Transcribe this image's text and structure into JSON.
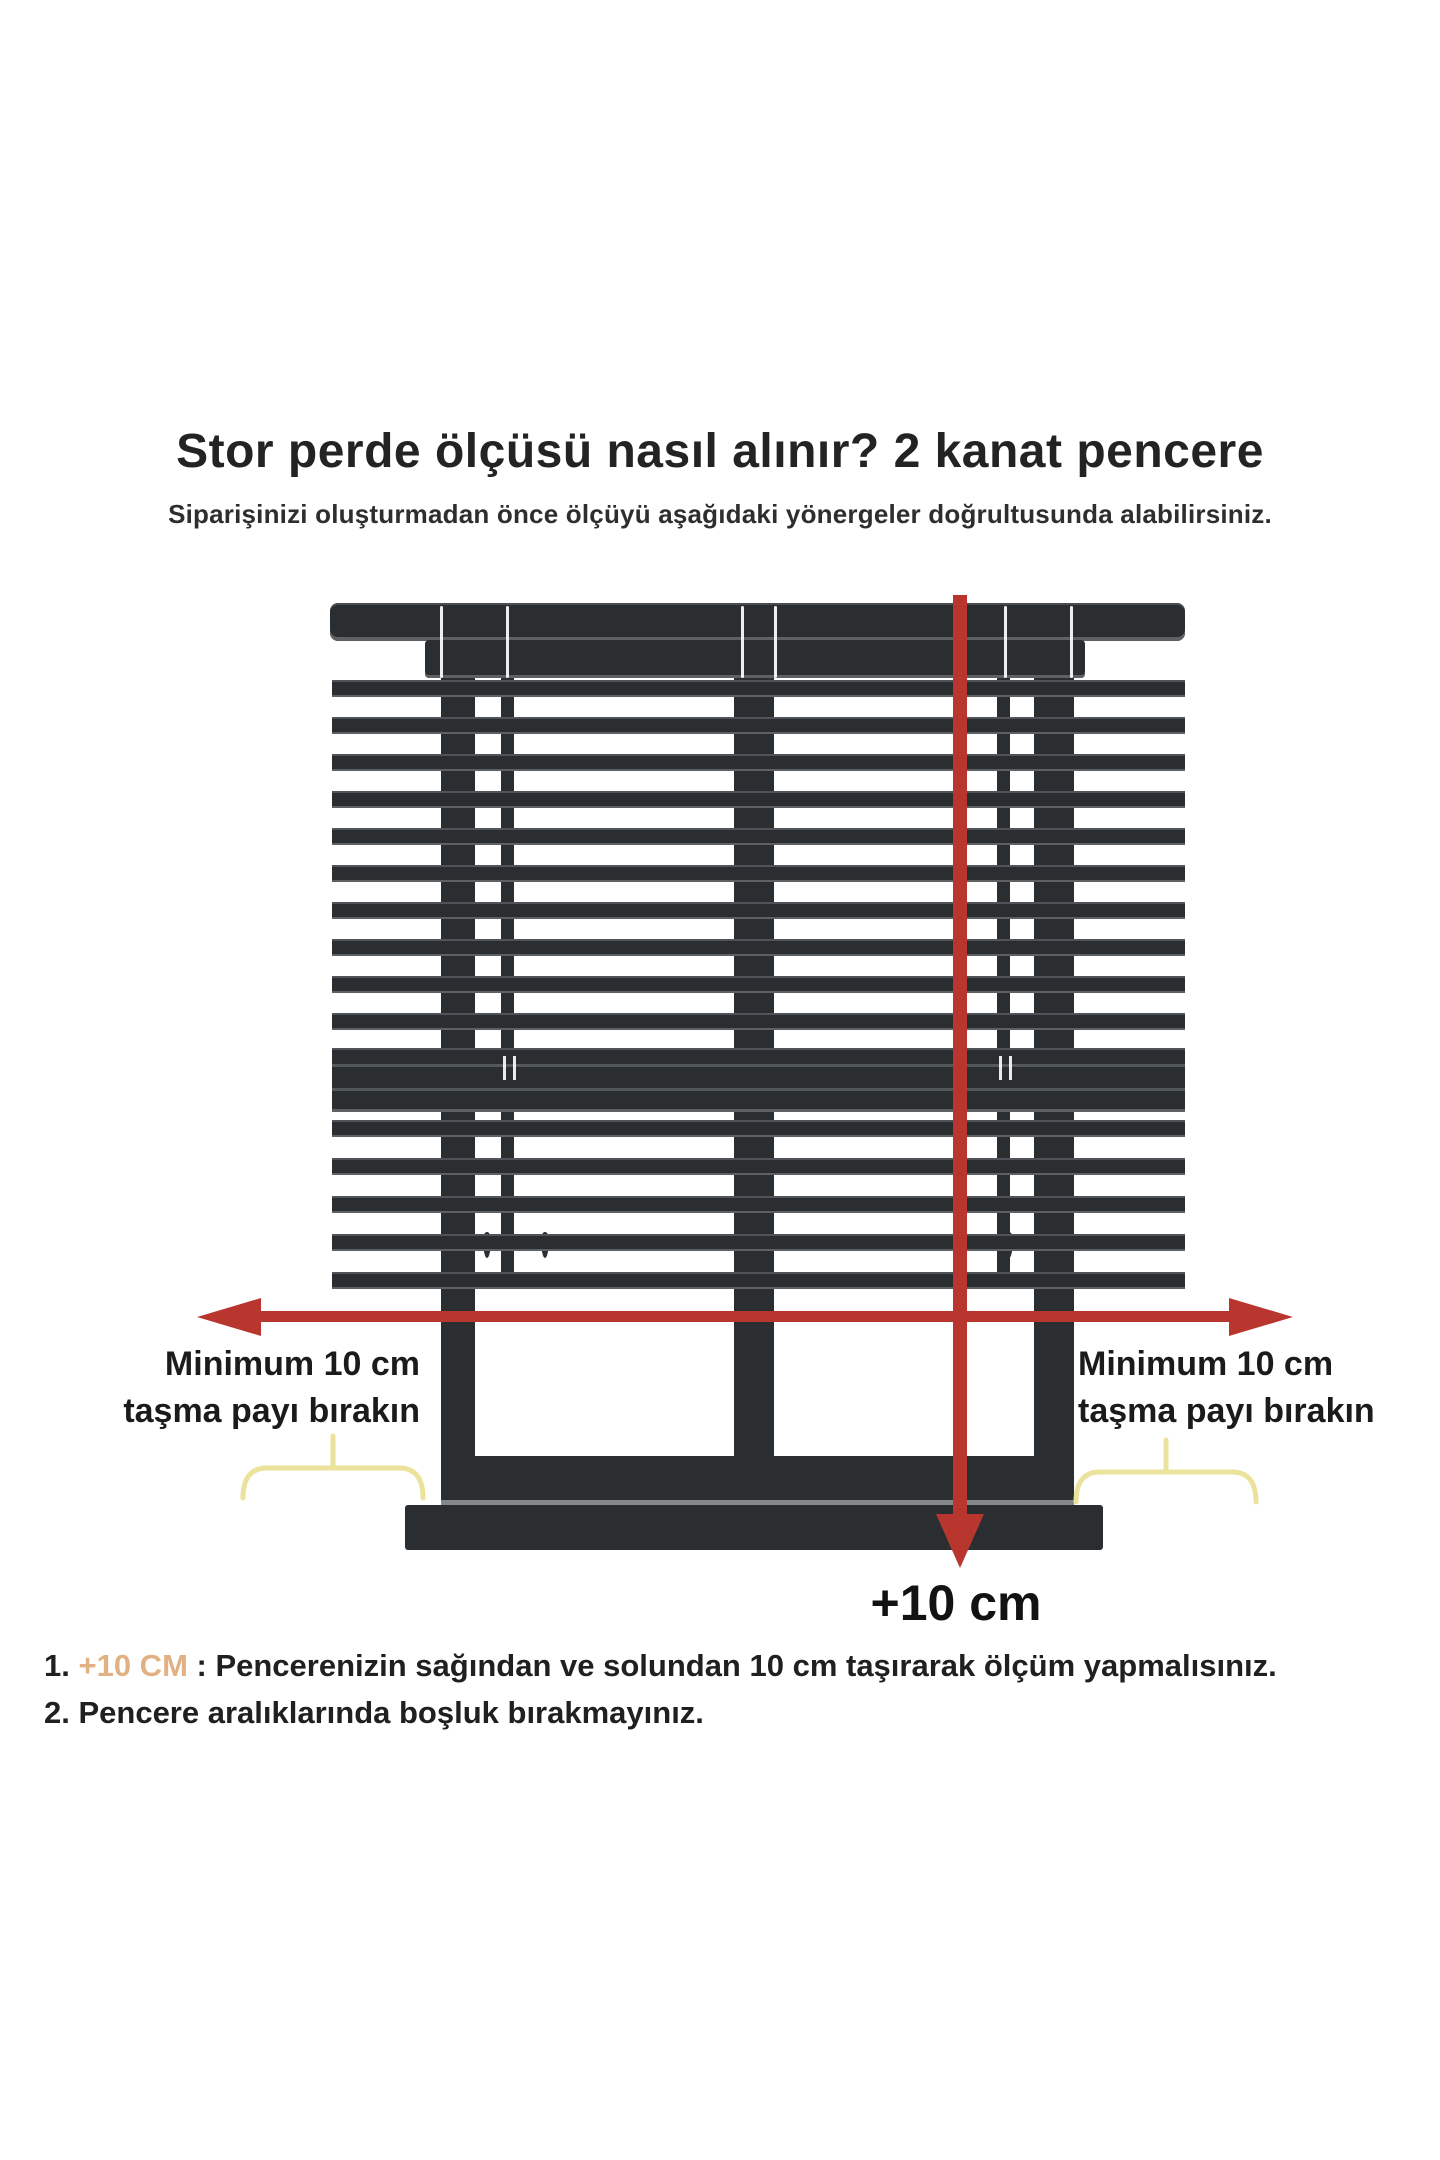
{
  "header": {
    "title": "Stor perde ölçüsü nasıl alınır? 2 kanat pencere",
    "subtitle": "Siparişinizi oluşturmadan önce ölçüyü aşağıdaki yönergeler doğrultusunda alabilirsiniz."
  },
  "diagram": {
    "left_label": {
      "line1": "Minimum 10 cm",
      "line2": "taşma payı bırakın"
    },
    "right_label": {
      "line1": "Minimum 10 cm",
      "line2": "taşma payı bırakın"
    },
    "bottom_arrow_label": "+10 cm",
    "colors": {
      "frame": "#2b2e30",
      "edge_gray": "#5d6164",
      "arrow_red": "#b9362f",
      "brace_yellow": "#ebe29b"
    }
  },
  "notes": {
    "highlight_color": "#e2b183",
    "items": [
      {
        "number": "1.",
        "highlight": "+10 CM",
        "text": " : Pencerenizin sağından ve solundan 10 cm taşırarak ölçüm yapmalısınız."
      },
      {
        "number": "2.",
        "highlight": "",
        "text": " Pencere aralıklarında boşluk bırakmayınız."
      }
    ]
  }
}
